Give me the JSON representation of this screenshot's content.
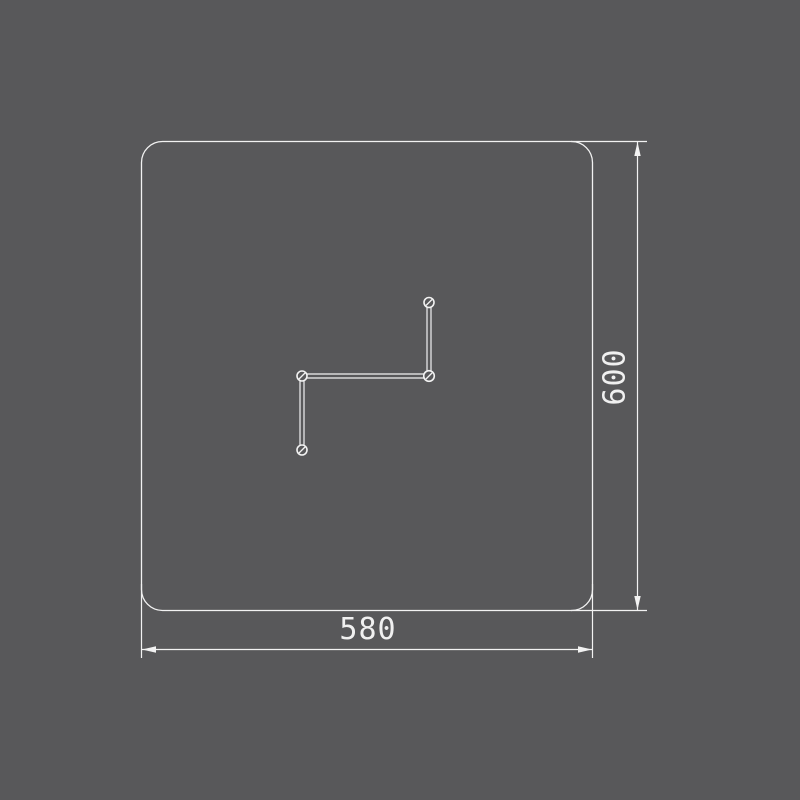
{
  "colors": {
    "background": "#58585a",
    "line": "#f2f2f2",
    "text": "#f0f0f0"
  },
  "drawing": {
    "dimensions": {
      "width": {
        "label": "580"
      },
      "height": {
        "label": "600"
      }
    },
    "holes": {
      "count": 4,
      "markers": [
        "top",
        "junction",
        "left",
        "bottom"
      ]
    }
  }
}
